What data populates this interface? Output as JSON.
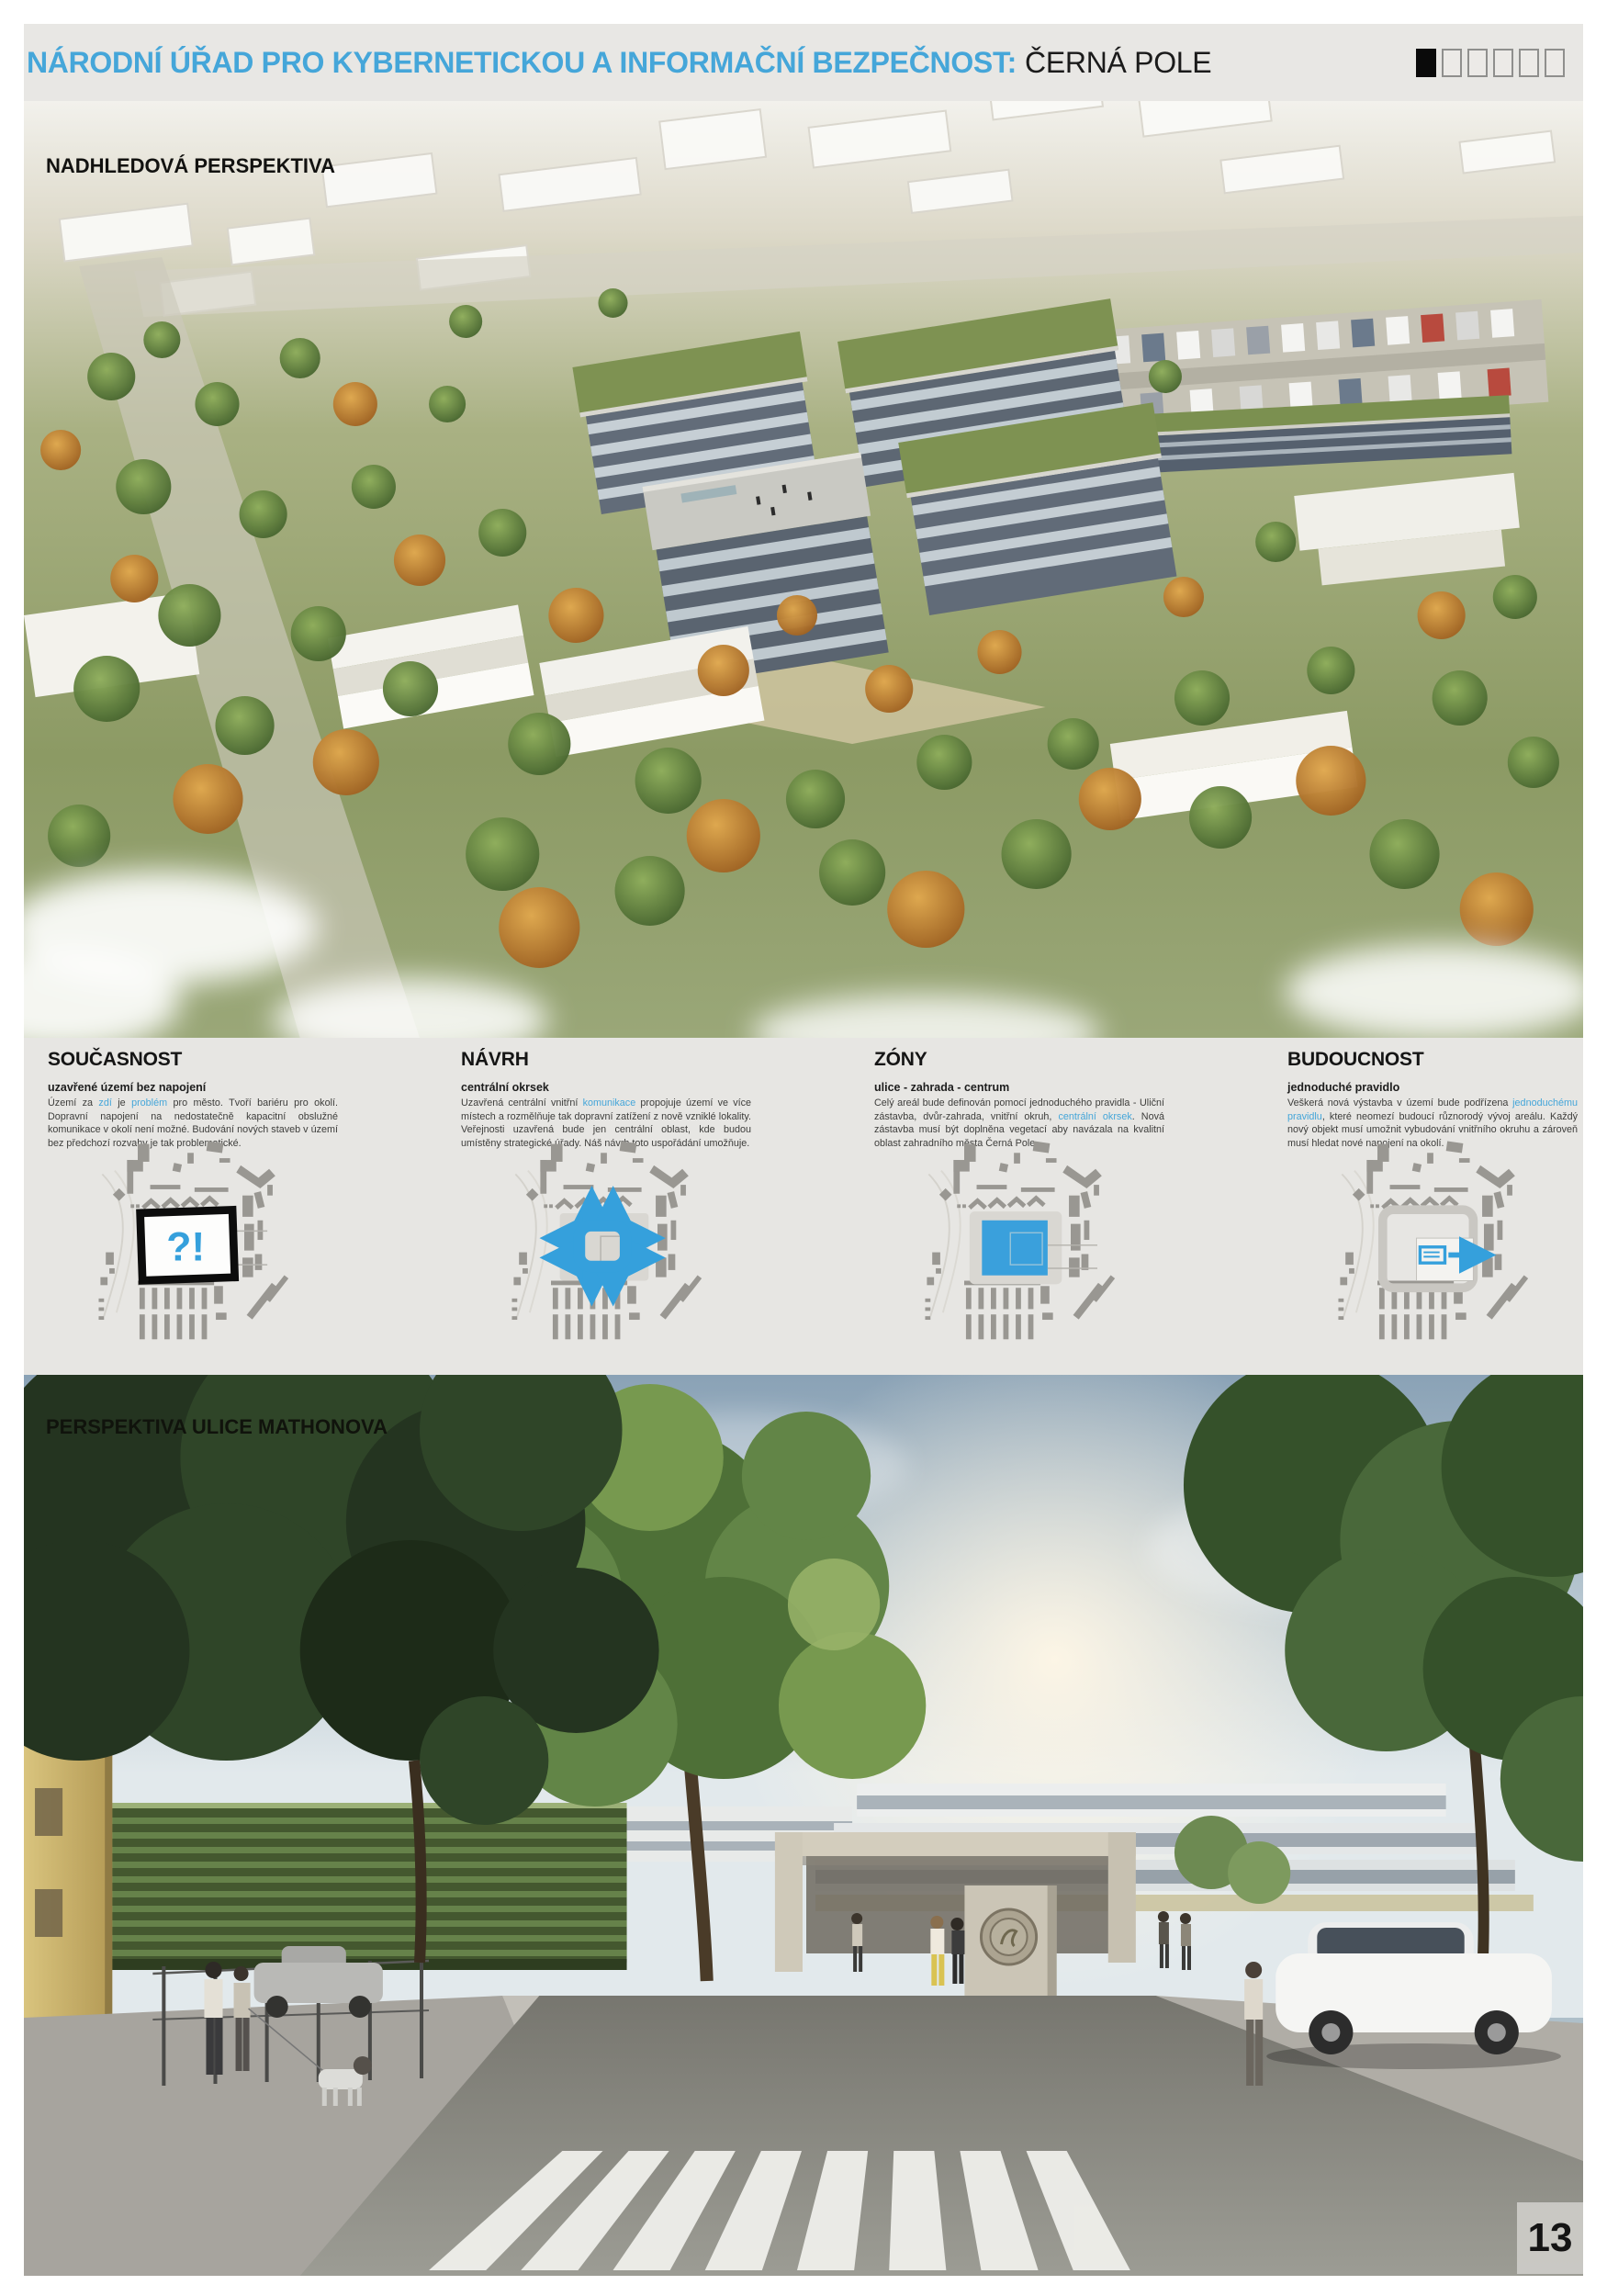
{
  "colors": {
    "accent": "#45a6d9",
    "diagram_blue": "#35a0dc",
    "header_background": "#e8e7e4",
    "info_band_background": "#e7e6e3"
  },
  "header": {
    "title_blue": "NÁRODNÍ ÚŘAD PRO KYBERNETICKOU A INFORMAČNÍ BEZPEČNOST:",
    "title_black": "ČERNÁ POLE",
    "page_indicator": {
      "total": 6,
      "active": 1
    }
  },
  "aerial_view": {
    "label": "NADHLEDOVÁ PERSPEKTIVA"
  },
  "street_view": {
    "label": "PERSPEKTIVA ULICE MATHONOVA",
    "gate_sign": "NÚKIB"
  },
  "sections": [
    {
      "title": "SOUČASNOST",
      "subtitle": "uzavřené území bez napojení",
      "body": [
        {
          "t": "Území za "
        },
        {
          "t": "zdí",
          "hl": true
        },
        {
          "t": " je "
        },
        {
          "t": "problém",
          "hl": true
        },
        {
          "t": " pro město. Tvoří bariéru pro okolí. Dopravní napojení na nedostatečně kapacitní obslužné komunikace v okolí není možné. Budování nových staveb v území bez předchozí rozvahy je tak problematické."
        }
      ],
      "diagram": "walled-site-question-plan",
      "diagram_text": "?!"
    },
    {
      "title": "NÁVRH",
      "subtitle": "centrální okrsek",
      "body": [
        {
          "t": "Uzavřená centrální vnitřní "
        },
        {
          "t": "komunikace",
          "hl": true
        },
        {
          "t": " propojuje území ve více místech a rozmělňuje tak dopravní zatížení z nově vzniklé lokality. Veřejnosti uzavřená bude jen centrální oblast, kde budou umístěny strategické úřady. Náš návrh toto uspořádání umožňuje."
        }
      ],
      "diagram": "circuit-loop-arrows-plan",
      "diagram_text": ""
    },
    {
      "title": "ZÓNY",
      "subtitle": "ulice - zahrada - centrum",
      "body": [
        {
          "t": "Celý areál bude definován pomocí jednoduchého pravidla - Uliční zástavba, dvůr-zahrada, vnitřní okruh, "
        },
        {
          "t": "centrální okrsek",
          "hl": true
        },
        {
          "t": ". Nová zástavba musí být doplněna vegetací aby navázala na kvalitní oblast zahradního města Černá Pole."
        }
      ],
      "diagram": "blue-zone-plan",
      "diagram_text": ""
    },
    {
      "title": "BUDOUCNOST",
      "subtitle": "jednoduché pravidlo",
      "body": [
        {
          "t": "Veškerá nová výstavba v území bude podřízena "
        },
        {
          "t": "jednoduchému pravidlu",
          "hl": true
        },
        {
          "t": ", které neomezí budoucí různorodý vývoj areálu. Každý nový objekt musí umožnit vybudování vnitřního okruhu a zároveň musí hledat nové napojení na okolí."
        }
      ],
      "diagram": "growth-rule-arrow-plan",
      "diagram_text": ""
    }
  ],
  "page_number": "13"
}
